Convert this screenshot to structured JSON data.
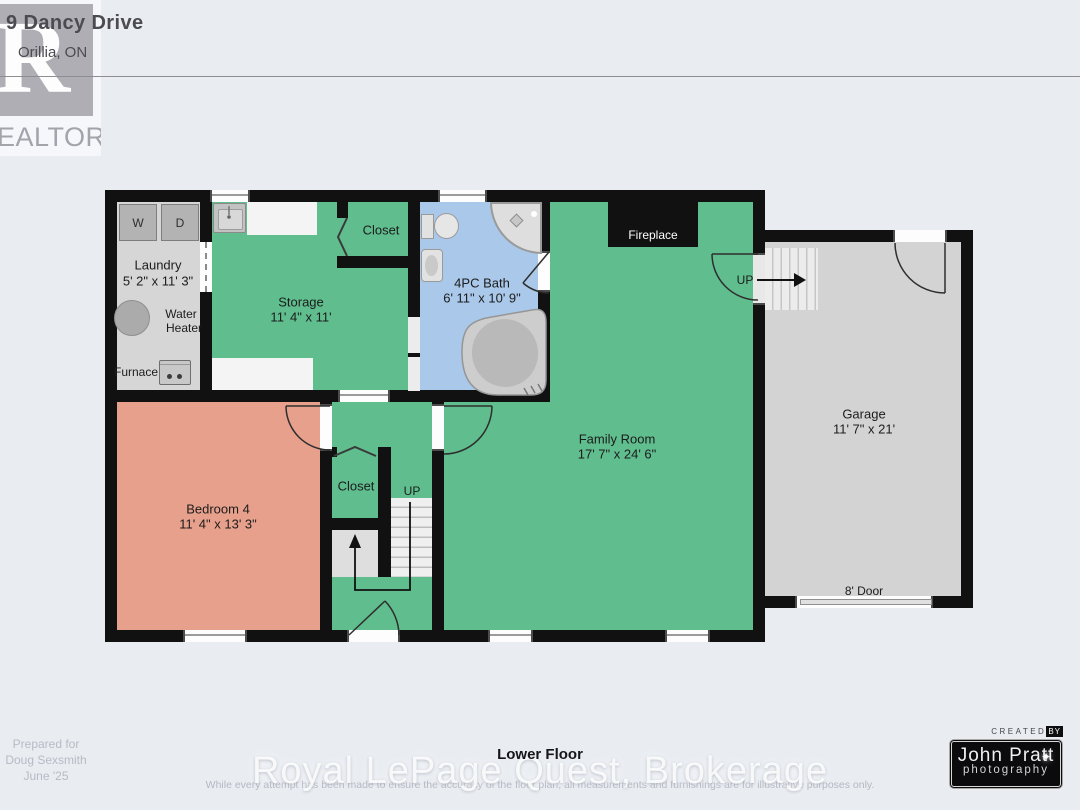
{
  "header": {
    "address_line1": "9 Dancy Drive",
    "address_line2": "Orillia, ON",
    "realtor_letter": "R",
    "realtor_wordmark": "REALTOR®"
  },
  "rooms": {
    "laundry": {
      "name": "Laundry",
      "dims": "5' 2\" x 11' 3\""
    },
    "storage": {
      "name": "Storage",
      "dims": "11' 4\" x 11'"
    },
    "closet_upper": {
      "name": "Closet"
    },
    "bath": {
      "name": "4PC Bath",
      "dims": "6' 11\" x 10' 9\""
    },
    "family_room": {
      "name": "Family Room",
      "dims": "17' 7\" x 24' 6\""
    },
    "garage": {
      "name": "Garage",
      "dims": "11' 7\" x 21'"
    },
    "bedroom4": {
      "name": "Bedroom 4",
      "dims": "11' 4\" x 13' 3\""
    },
    "closet_hall": {
      "name": "Closet"
    }
  },
  "labels": {
    "fireplace": "Fireplace",
    "up_to_garage": "UP",
    "up_stairs": "UP",
    "washer": "W",
    "dryer": "D",
    "water_heater_line1": "Water",
    "water_heater_line2": "Heater",
    "furnace": "Furnace",
    "garage_door": "8' Door"
  },
  "footer": {
    "prepared_line1": "Prepared for",
    "prepared_line2": "Doug Sexsmith",
    "prepared_line3": "June '25",
    "floor_title": "Lower Floor",
    "brokerage_watermark": "Royal LePage Quest, Brokerage",
    "disclaimer": "While every attempt has been made to ensure the accuracy of the floor plan, all measurements and furnishings are for illustrative purposes only."
  },
  "credit": {
    "created_prefix": "CREATED",
    "created_chip": "BY",
    "studio_name": "John Pratt",
    "studio_sub": "photography",
    "flare_icon": "✦"
  },
  "colors": {
    "wall": "#111111",
    "room_green": "#5fbd8e",
    "bedroom_salmon": "#e7a08c",
    "bath_blue": "#aac8ea",
    "laundry_gray": "#d6d6d6",
    "garage_gray": "#d3d3d3",
    "background": "#e9edf2"
  }
}
